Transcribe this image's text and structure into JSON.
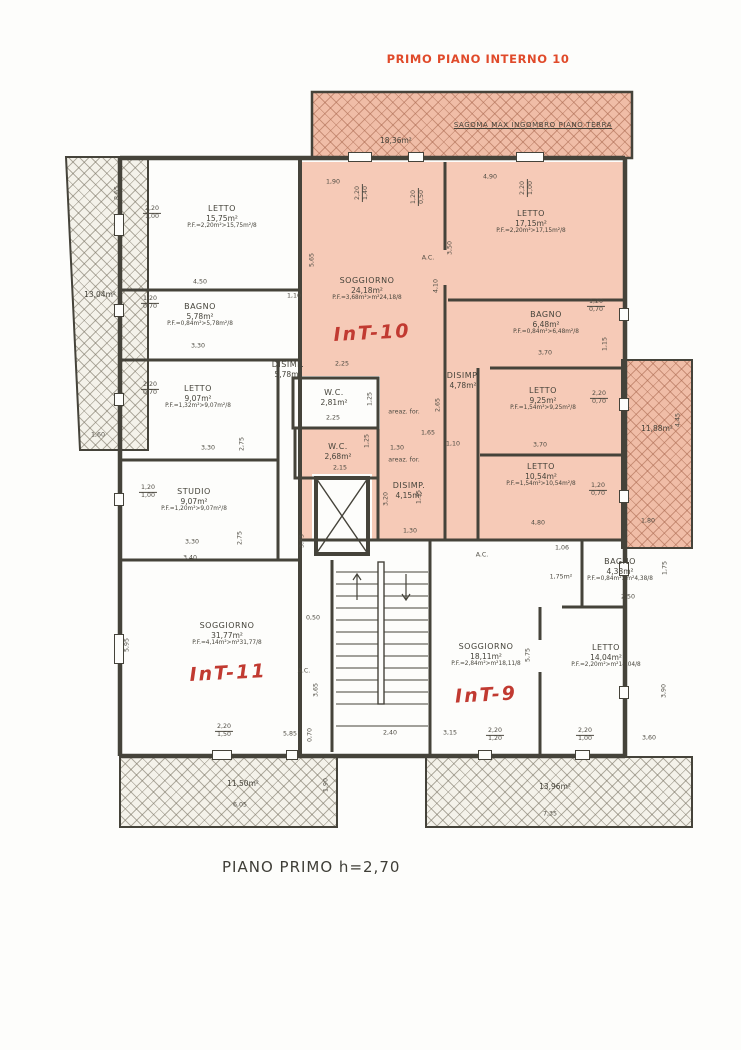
{
  "page": {
    "title": "PRIMO PIANO INTERNO 10",
    "footer": "PIANO PRIMO h=2,70"
  },
  "colors": {
    "title_red": "#e04a2a",
    "hand_red": "#c13a31",
    "wall": "#45433a",
    "unit10_pink": "#f6cab7",
    "hatch_pink": "#f0bda7",
    "hatch_grey": "#f4f2ea"
  },
  "sagoma": {
    "area": "18,36m²",
    "label": "SAGOMA MAX INGOMBRO PIANO TERRA"
  },
  "balconies": [
    {
      "position": "left",
      "area": "13,04m²"
    },
    {
      "position": "right",
      "area": "11,88m²"
    },
    {
      "position": "bottom-left",
      "area": "11,50m²"
    },
    {
      "position": "bottom-right",
      "area": "13,96m²"
    }
  ],
  "units": [
    {
      "id": "INT-10",
      "handwritten": "InT-10"
    },
    {
      "id": "INT-11",
      "handwritten": "InT-11"
    },
    {
      "id": "INT-9",
      "handwritten": "InT-9"
    }
  ],
  "rooms": [
    {
      "name": "LETTO",
      "area": "15,75m²",
      "pf": "P.F.=2,20m²>15,75m²/8"
    },
    {
      "name": "BAGNO",
      "area": "5,78m²",
      "pf": "P.F.=0,84m²>5,78m²/8"
    },
    {
      "name": "DISIMP.",
      "area": "5,78m²",
      "pf": ""
    },
    {
      "name": "LETTO",
      "area": "9,07m²",
      "pf": "P.F.=1,32m²>9,07m²/8"
    },
    {
      "name": "STUDIO",
      "area": "9,07m²",
      "pf": "P.F.=1,20m²>9,07m²/8"
    },
    {
      "name": "SOGGIORNO",
      "area": "31,77m²",
      "pf": "P.F.=4,14m²>m²31,77/8"
    },
    {
      "name": "W.C.",
      "area": "2,81m²",
      "pf": ""
    },
    {
      "name": "SOGGIORNO",
      "area": "24,18m²",
      "pf": "P.F.=3,68m²>m²24,18/8"
    },
    {
      "name": "LETTO",
      "area": "17,15m²",
      "pf": "P.F.=2,20m²>17,15m²/8"
    },
    {
      "name": "BAGNO",
      "area": "6,48m²",
      "pf": "P.F.=0,84m²>6,48m²/8"
    },
    {
      "name": "LETTO",
      "area": "9,25m²",
      "pf": "P.F.=1,54m²>9,25m²/8"
    },
    {
      "name": "LETTO",
      "area": "10,54m²",
      "pf": "P.F.=1,54m²>10,54m²/8"
    },
    {
      "name": "DISIMP.",
      "area": "4,78m²",
      "pf": ""
    },
    {
      "name": "W.C.",
      "area": "2,68m²",
      "pf": ""
    },
    {
      "name": "DISIMP.",
      "area": "4,15m²",
      "pf": ""
    },
    {
      "name": "SOGGIORNO",
      "area": "18,11m²",
      "pf": "P.F.=2,84m²>m²18,11/8"
    },
    {
      "name": "LETTO",
      "area": "14,04m²",
      "pf": "P.F.=2,20m²>m²14,04/8"
    },
    {
      "name": "BAGNO",
      "area": "4,38m²",
      "pf": "P.F.=0,84m²>m²4,38/8"
    }
  ],
  "annotations": [
    {
      "fr": [
        "2,20",
        "1,00"
      ],
      "x": 152,
      "y": 213
    },
    {
      "t": "4,50",
      "x": 200,
      "y": 283
    },
    {
      "fr": [
        "1,20",
        "0,70"
      ],
      "x": 150,
      "y": 303
    },
    {
      "t": "3,30",
      "x": 198,
      "y": 347
    },
    {
      "t": "1,10",
      "x": 294,
      "y": 297
    },
    {
      "fr": [
        "2,20",
        "0,70"
      ],
      "x": 150,
      "y": 389
    },
    {
      "t": "3,30",
      "x": 208,
      "y": 449
    },
    {
      "t": "2,75",
      "x": 243,
      "y": 444,
      "rot": 1
    },
    {
      "fr": [
        "1,20",
        "1,00"
      ],
      "x": 148,
      "y": 492
    },
    {
      "t": "3,30",
      "x": 192,
      "y": 543
    },
    {
      "t": "2,75",
      "x": 241,
      "y": 538,
      "rot": 1
    },
    {
      "t": "3,40",
      "x": 190,
      "y": 559
    },
    {
      "t": "5,95",
      "x": 128,
      "y": 645,
      "rot": 1
    },
    {
      "fr": [
        "2,20",
        "1,50"
      ],
      "x": 224,
      "y": 731
    },
    {
      "t": "5,85",
      "x": 290,
      "y": 735
    },
    {
      "t": "0,70",
      "x": 311,
      "y": 735,
      "rot": 1
    },
    {
      "t": "0,50",
      "x": 313,
      "y": 619
    },
    {
      "t": "A.C.",
      "x": 304,
      "y": 672
    },
    {
      "t": "3,65",
      "x": 317,
      "y": 690,
      "rot": 1
    },
    {
      "t": "1,90",
      "x": 333,
      "y": 183
    },
    {
      "fr": [
        "2,20",
        "1,40"
      ],
      "x": 362,
      "y": 193,
      "rot": 1
    },
    {
      "fr": [
        "1,20",
        "0,50"
      ],
      "x": 418,
      "y": 197,
      "rot": 1
    },
    {
      "t": "4,90",
      "x": 490,
      "y": 178
    },
    {
      "fr": [
        "2,20",
        "1,00"
      ],
      "x": 527,
      "y": 188,
      "rot": 1
    },
    {
      "t": "5,65",
      "x": 313,
      "y": 260,
      "rot": 1
    },
    {
      "t": "A.C.",
      "x": 428,
      "y": 259
    },
    {
      "t": "4,10",
      "x": 437,
      "y": 286,
      "rot": 1
    },
    {
      "t": "3,50",
      "x": 451,
      "y": 248,
      "rot": 1
    },
    {
      "t": "2,25",
      "x": 342,
      "y": 365
    },
    {
      "t": "1,25",
      "x": 371,
      "y": 399,
      "rot": 1
    },
    {
      "t": "2,25",
      "x": 333,
      "y": 419
    },
    {
      "t": "areaz. for.",
      "x": 404,
      "y": 413
    },
    {
      "t": "1,65",
      "x": 428,
      "y": 434
    },
    {
      "t": "2,65",
      "x": 439,
      "y": 405,
      "rot": 1
    },
    {
      "t": "1,30",
      "x": 397,
      "y": 449
    },
    {
      "t": "areaz. for.",
      "x": 404,
      "y": 461
    },
    {
      "t": "2,15",
      "x": 340,
      "y": 469
    },
    {
      "t": "1,25",
      "x": 368,
      "y": 441,
      "rot": 1
    },
    {
      "t": "3,20",
      "x": 387,
      "y": 499,
      "rot": 1
    },
    {
      "t": "1,35",
      "x": 420,
      "y": 497,
      "rot": 1
    },
    {
      "t": "1,30",
      "x": 410,
      "y": 532
    },
    {
      "t": "3,75",
      "x": 303,
      "y": 541,
      "rot": 1
    },
    {
      "fr": [
        "1,20",
        "0,70"
      ],
      "x": 596,
      "y": 306
    },
    {
      "t": "1,15",
      "x": 606,
      "y": 344,
      "rot": 1
    },
    {
      "t": "3,70",
      "x": 545,
      "y": 354
    },
    {
      "fr": [
        "2,20",
        "0,70"
      ],
      "x": 599,
      "y": 398
    },
    {
      "t": "3,70",
      "x": 540,
      "y": 446
    },
    {
      "fr": [
        "1,20",
        "0,70"
      ],
      "x": 598,
      "y": 490
    },
    {
      "t": "1,10",
      "x": 453,
      "y": 445
    },
    {
      "t": "4,80",
      "x": 538,
      "y": 524
    },
    {
      "t": "1,06",
      "x": 562,
      "y": 549
    },
    {
      "t": "1,75m²",
      "x": 561,
      "y": 578
    },
    {
      "t": "2,50",
      "x": 628,
      "y": 598
    },
    {
      "t": "1,75",
      "x": 666,
      "y": 568,
      "rot": 1
    },
    {
      "t": "5,75",
      "x": 529,
      "y": 655,
      "rot": 1
    },
    {
      "t": "3,90",
      "x": 665,
      "y": 691,
      "rot": 1
    },
    {
      "t": "2,40",
      "x": 390,
      "y": 734
    },
    {
      "t": "3,15",
      "x": 450,
      "y": 734
    },
    {
      "fr": [
        "2,20",
        "1,20"
      ],
      "x": 495,
      "y": 735
    },
    {
      "fr": [
        "2,20",
        "1,00"
      ],
      "x": 585,
      "y": 735
    },
    {
      "t": "3,60",
      "x": 649,
      "y": 739
    },
    {
      "t": "8,65",
      "x": 118,
      "y": 193,
      "rot": 1
    },
    {
      "t": "1,60",
      "x": 98,
      "y": 436
    },
    {
      "t": "4,45",
      "x": 679,
      "y": 420,
      "rot": 1
    },
    {
      "t": "1,80",
      "x": 648,
      "y": 522
    },
    {
      "t": "6,05",
      "x": 240,
      "y": 806
    },
    {
      "t": "1,90",
      "x": 327,
      "y": 785,
      "rot": 1
    },
    {
      "t": "7,35",
      "x": 550,
      "y": 815
    },
    {
      "t": "A.C.",
      "x": 482,
      "y": 556
    }
  ]
}
